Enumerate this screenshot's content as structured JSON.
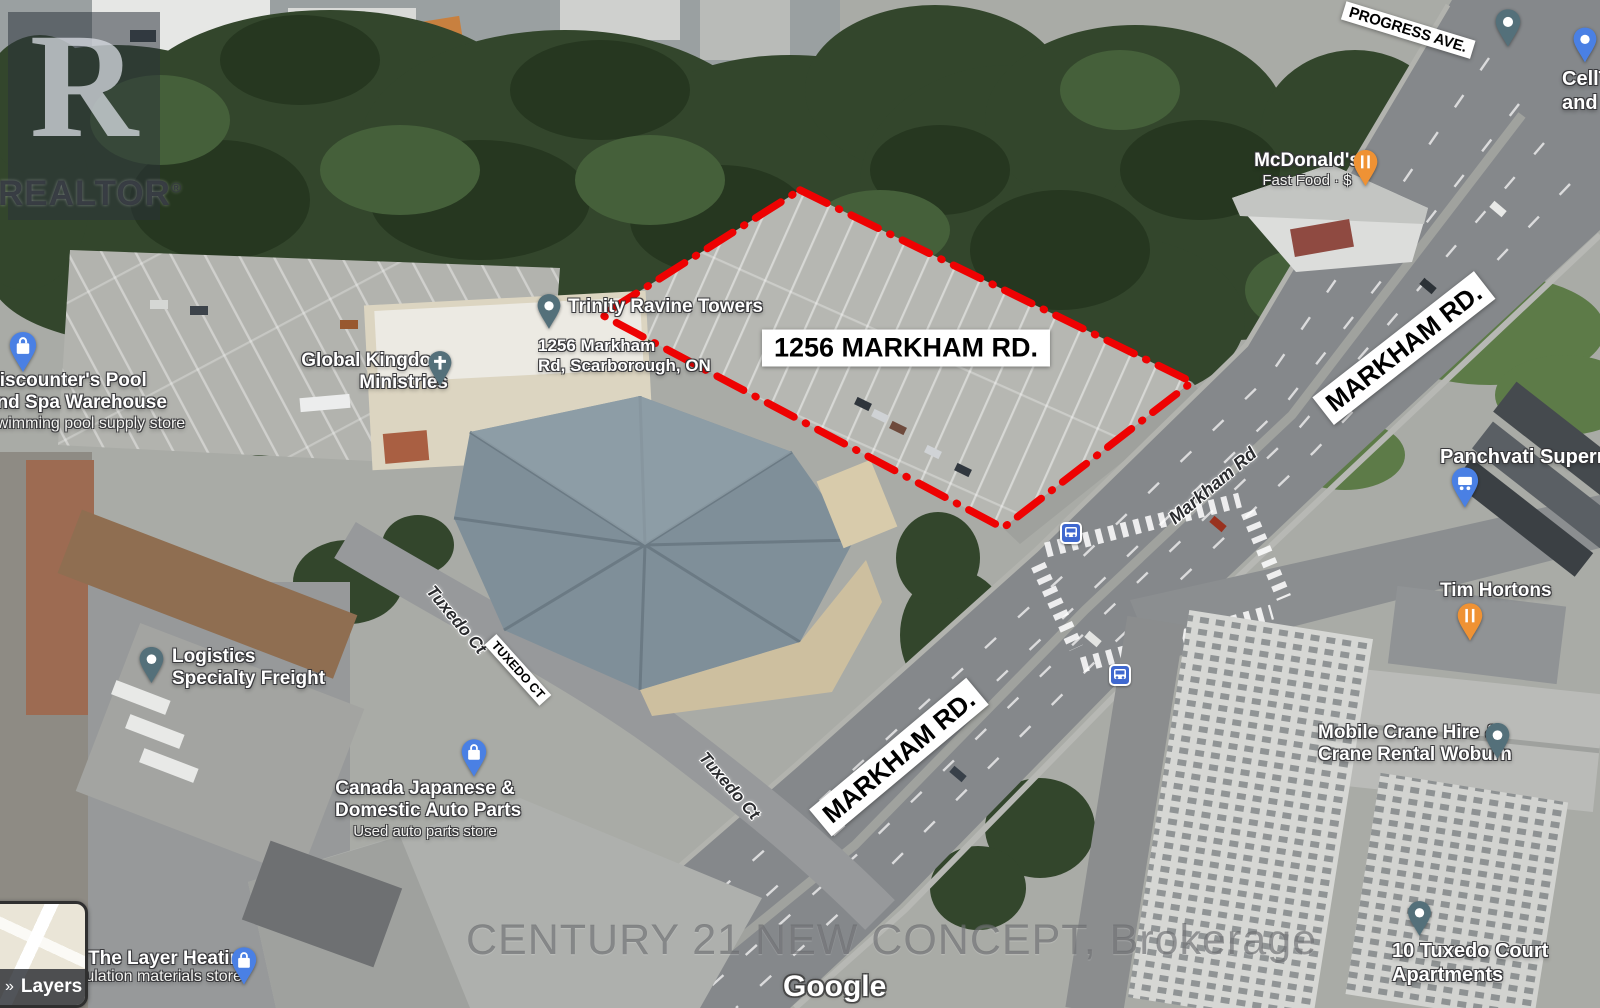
{
  "colors": {
    "property_outline": "#ee0202",
    "poi_pin_teal": "#54707a",
    "poi_pin_orange": "#ef9234",
    "poi_pin_blue": "#4a80e4",
    "bus_icon_blue": "#3f68cf"
  },
  "watermark": {
    "realtor_letter": "R",
    "realtor_name": "REALTOR",
    "registered_mark": "®",
    "brokerage_line": "CENTURY 21 NEW CONCEPT, Brokerage",
    "google_logo": "Google"
  },
  "map_controls": {
    "layers_label": "Layers",
    "layers_chevron": "»"
  },
  "property": {
    "highlight_label": "1256 MARKHAM RD."
  },
  "road_signs": {
    "progress_ave": "PROGRESS AVE.",
    "markham_rd_upper": "MARKHAM RD.",
    "markham_rd_lower": "MARKHAM RD.",
    "tuxedo_ct": "TUXEDO CT"
  },
  "street_labels": {
    "tuxedo_upper": "Tuxedo Ct",
    "tuxedo_lower": "Tuxedo Ct",
    "markham": "Markham Rd"
  },
  "pois": {
    "trinity": {
      "name": "Trinity Ravine Towers"
    },
    "property_address": {
      "line1": "1256 Markham",
      "line2": "Rd, Scarborough, ON"
    },
    "global_kingdom": {
      "line1": "Global Kingdom",
      "line2": "Ministries"
    },
    "discounters": {
      "line1": "Discounter's Pool",
      "line2": "and Spa Warehouse",
      "sub": "Swimming pool supply store"
    },
    "mcdonalds": {
      "name": "McDonald's",
      "sub": "Fast Food · $"
    },
    "cell_store": {
      "line1": "CellT",
      "line2": "and l"
    },
    "panchvati": {
      "name": "Panchvati Supermarket"
    },
    "tim_hortons": {
      "name": "Tim Hortons"
    },
    "logistics": {
      "line1": "Logistics",
      "line2": "Specialty Freight"
    },
    "auto_parts": {
      "line1": "Canada Japanese &",
      "line2": "Domestic Auto Parts",
      "sub": "Used auto parts store"
    },
    "mobile_crane": {
      "line1": "Mobile Crane Hire &",
      "line2": "Crane Rental Woburn"
    },
    "layer_heating": {
      "line1": "The Layer Heating",
      "sub": "Insulation materials store"
    },
    "tuxedo_apartments": {
      "line1": "10 Tuxedo Court",
      "line2": "Apartments"
    }
  }
}
